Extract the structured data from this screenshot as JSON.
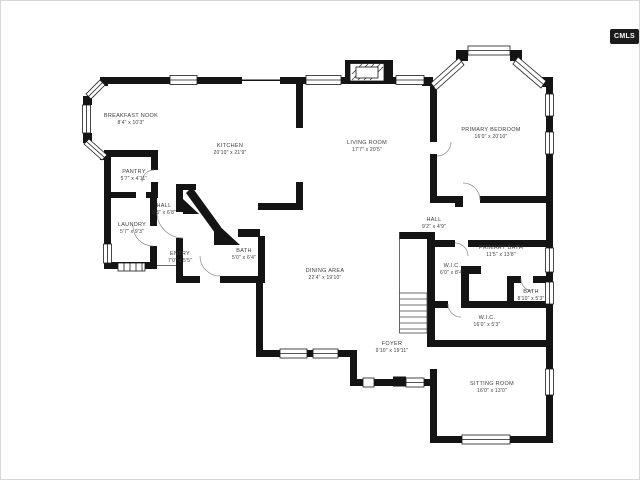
{
  "logo": {
    "text": "CMLS"
  },
  "floor_plan": {
    "type": "residential-floor-plan",
    "wall_color": "#141414",
    "label_color": "#3c3c3c",
    "rooms": [
      {
        "name": "BREAKFAST NOOK",
        "dims": "8'4\" x 10'3\"",
        "x": 131,
        "y": 120
      },
      {
        "name": "KITCHEN",
        "dims": "20'10\" x 21'9\"",
        "x": 230,
        "y": 150
      },
      {
        "name": "LIVING ROOM",
        "dims": "17'7\" x 20'5\"",
        "x": 367,
        "y": 147
      },
      {
        "name": "PRIMARY BEDROOM",
        "dims": "16'0\" x 20'10\"",
        "x": 491,
        "y": 134
      },
      {
        "name": "PANTRY",
        "dims": "5'7\" x 4'11\"",
        "x": 134,
        "y": 176
      },
      {
        "name": "HALL",
        "dims": "3'3\" x 6'8\"",
        "x": 164,
        "y": 210
      },
      {
        "name": "LAUNDRY",
        "dims": "5'7\" x 9'3\"",
        "x": 132,
        "y": 229
      },
      {
        "name": "ENTRY",
        "dims": "7'0\" x 5'5\"",
        "x": 180,
        "y": 258
      },
      {
        "name": "BATH",
        "dims": "5'0\" x 6'4\"",
        "x": 244,
        "y": 255
      },
      {
        "name": "DINING AREA",
        "dims": "22'4\" x 19'10\"",
        "x": 325,
        "y": 275
      },
      {
        "name": "HALL",
        "dims": "9'2\" x 4'9\"",
        "x": 434,
        "y": 224
      },
      {
        "name": "PRIMARY BATH",
        "dims": "11'5\" x 13'8\"",
        "x": 501,
        "y": 252
      },
      {
        "name": "W.I.C.",
        "dims": "6'0\" x 8'4\"",
        "x": 452,
        "y": 270
      },
      {
        "name": "BATH",
        "dims": "8'10\" x 5'3\"",
        "x": 531,
        "y": 296
      },
      {
        "name": "W.I.C.",
        "dims": "16'0\" x 5'3\"",
        "x": 487,
        "y": 322
      },
      {
        "name": "FOYER",
        "dims": "9'10\" x 19'11\"",
        "x": 392,
        "y": 348
      },
      {
        "name": "SITTING ROOM",
        "dims": "16'0\" x 13'0\"",
        "x": 492,
        "y": 388
      }
    ]
  }
}
